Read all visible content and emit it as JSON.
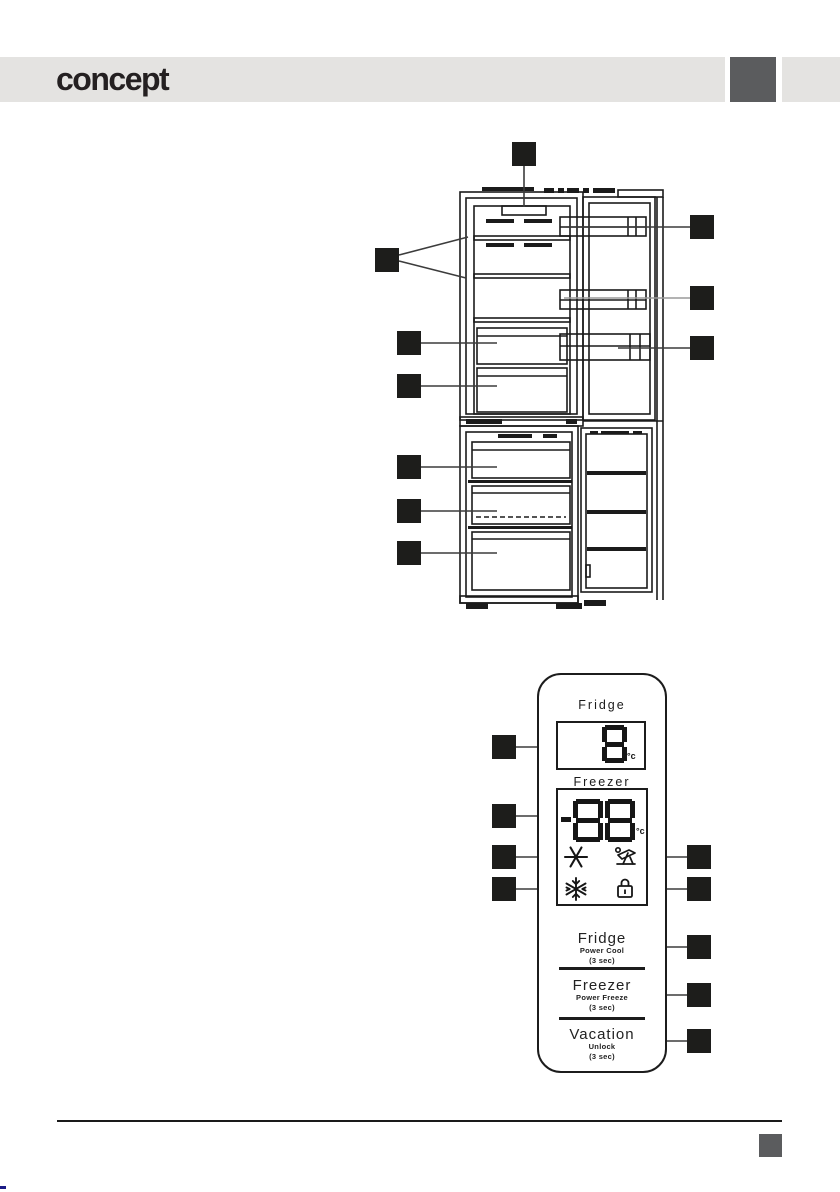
{
  "header": {
    "logo": "concept",
    "bar_color": "#e4e3e1",
    "accent_square_color": "#5b5c5e"
  },
  "diagram": {
    "subject": "refrigerator interior line drawing with callout markers",
    "marker_color": "#1d1d1b",
    "fridge_marker_count": 10,
    "panel_marker_count": 9
  },
  "control_panel": {
    "fridge_label": "Fridge",
    "fridge_display": {
      "value": "8",
      "unit": "°c"
    },
    "freezer_label": "Freezer",
    "freezer_display": {
      "value": "-88",
      "unit": "°c"
    },
    "indicator_icons": [
      {
        "name": "cool-icon"
      },
      {
        "name": "vacation-icon"
      },
      {
        "name": "freeze-icon"
      },
      {
        "name": "lock-icon"
      }
    ],
    "buttons": [
      {
        "label": "Fridge",
        "sub_label": "Power Cool",
        "hold_hint": "(3 sec)"
      },
      {
        "label": "Freezer",
        "sub_label": "Power Freeze",
        "hold_hint": "(3 sec)"
      },
      {
        "label": "Vacation",
        "sub_label": "Unlock",
        "hold_hint": "(3 sec)"
      }
    ]
  },
  "footer": {
    "rule_color": "#1a1a1a",
    "accent_square_color": "#5b5c5e"
  }
}
